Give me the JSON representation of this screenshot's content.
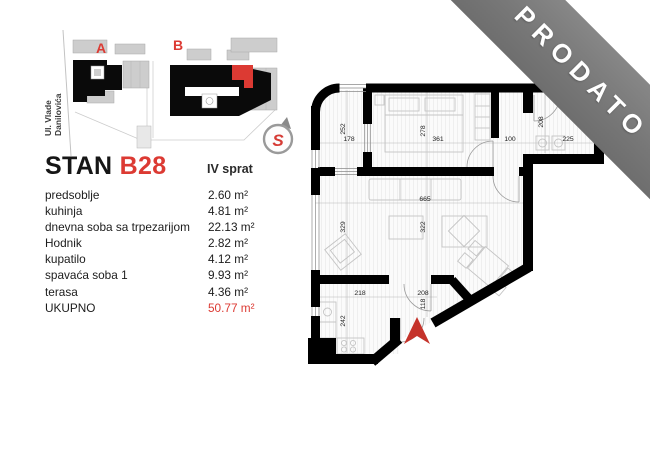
{
  "info": {
    "title": "STAN",
    "unit": "B28",
    "floor": "IV sprat",
    "rooms": [
      {
        "name": "predsoblje",
        "area": "2.60 m²"
      },
      {
        "name": "kuhinja",
        "area": "4.81 m²"
      },
      {
        "name": "dnevna soba sa trpezarijom",
        "area": "22.13 m²"
      },
      {
        "name": "Hodnik",
        "area": "2.82 m²"
      },
      {
        "name": "kupatilo",
        "area": "4.12 m²"
      },
      {
        "name": "spavaća soba 1",
        "area": "9.93 m²"
      },
      {
        "name": "terasa",
        "area": "4.36 m²"
      }
    ],
    "total_label": "UKUPNO",
    "total_area": "50.77 m²"
  },
  "siteplan": {
    "street": [
      "Ul. Vlade",
      "Danilovića"
    ],
    "building_a": "A",
    "building_b": "B",
    "compass": "S"
  },
  "floorplan": {
    "dims": {
      "terasa_h": "252",
      "terasa_w": "178",
      "bedroom_h": "278",
      "bedroom_w": "361",
      "hall_w": "100",
      "bath_h": "208",
      "bath_w": "225",
      "living_w": "665",
      "living_h_left": "329",
      "living_h_mid": "322",
      "kitchen_w": "218",
      "kitchen_h": "242",
      "entry_w": "208",
      "entry_h": "118"
    }
  },
  "banner": {
    "text": "PRODATO"
  },
  "colors": {
    "accent_red": "#dc3a33",
    "wall_black": "#000000",
    "banner_gray": "#7b7b7b",
    "furniture_gray": "#c4c4c4"
  }
}
